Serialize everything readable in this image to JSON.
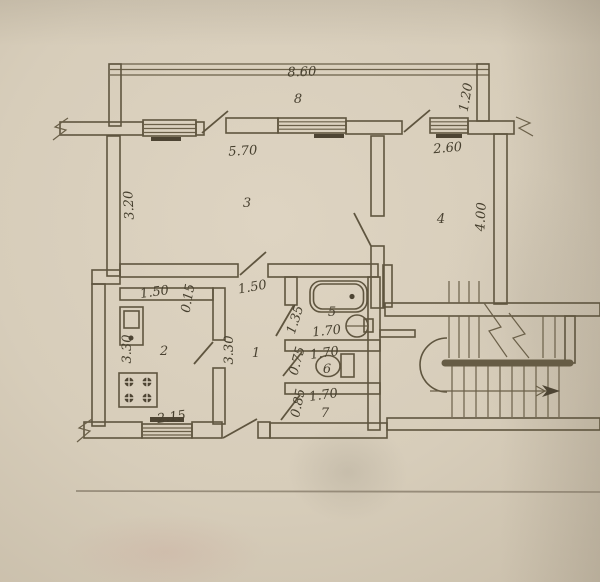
{
  "plan": {
    "rooms": [
      {
        "number": "8",
        "dimensions": [
          "8.60",
          "1.20"
        ]
      },
      {
        "number": "3",
        "dimensions": [
          "5.70",
          "3.20"
        ]
      },
      {
        "number": "4",
        "dimensions": [
          "2.60",
          "4.00"
        ]
      },
      {
        "number": "2",
        "dimensions": [
          "1.50",
          "0.15",
          "3.30",
          "2.15"
        ]
      },
      {
        "number": "1",
        "dimensions": [
          "1.50",
          "3.30"
        ]
      },
      {
        "number": "5",
        "dimensions": [
          "1.35",
          "1.70"
        ]
      },
      {
        "number": "6",
        "dimensions": [
          "0.75",
          "1.70"
        ]
      },
      {
        "number": "7",
        "dimensions": [
          "0.85",
          "1.70"
        ]
      }
    ],
    "fixtures": [
      "bathtub",
      "wash-basin",
      "toilet",
      "kitchen-sink",
      "stove",
      "staircase",
      "direction-arrow"
    ],
    "colors": {
      "paper": "#d8cebd",
      "ink": "#5f553f",
      "text": "#47402f"
    }
  },
  "labels": {
    "balcony_dim": "8.60",
    "balcony_num": "8",
    "balcony_width": "1.20",
    "room3_window": "5.70",
    "room3_height": "3.20",
    "room3_num": "3",
    "room4_window": "2.60",
    "room4_height": "4.00",
    "room4_num": "4",
    "kitchen_top": "1.50",
    "kitchen_offset": "0.15",
    "kitchen_height": "3.30",
    "kitchen_num": "2",
    "kitchen_window": "2.15",
    "hall_top": "1.50",
    "hall_height": "3.30",
    "hall_num": "1",
    "bath_width": "1.35",
    "bath_length": "1.70",
    "bath_num": "5",
    "wc_width": "0.75",
    "wc_length": "1.70",
    "wc_num": "6",
    "store_width": "0.85",
    "store_length": "1.70",
    "store_num": "7"
  }
}
